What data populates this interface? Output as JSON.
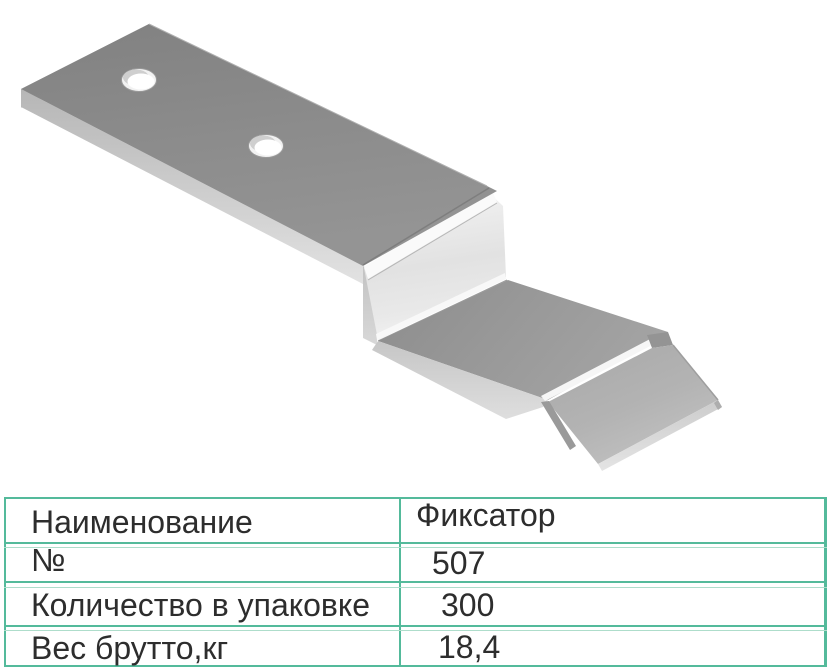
{
  "page": {
    "background": "#ffffff",
    "accent_color": "#54ba9b",
    "text_color": "#2d2d2d"
  },
  "illustration": {
    "name": "z-shaped-metal-fixator-bracket",
    "metal_dark": "#8a8a8a",
    "metal_mid": "#9b9b9b",
    "metal_light": "#e4e4e4",
    "edge_light": "#d6d6d6",
    "holes": 2
  },
  "table": {
    "border_color": "#54ba9b",
    "rows": [
      {
        "label": "Наименование",
        "value": "Фиксатор"
      },
      {
        "label": "№",
        "value": "507"
      },
      {
        "label": "Количество в упаковке",
        "value": "300"
      },
      {
        "label": "Вес брутто,кг",
        "value": "18,4"
      }
    ]
  }
}
